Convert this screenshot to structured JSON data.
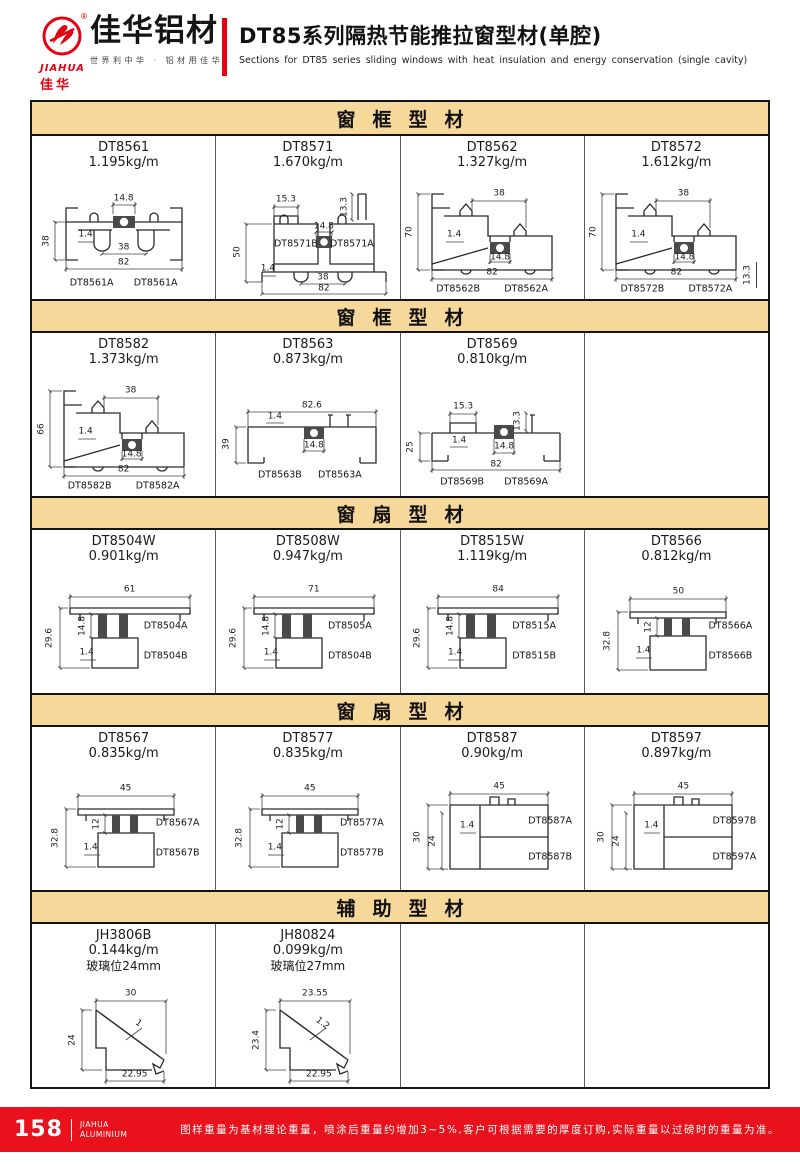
{
  "colors": {
    "accent_red": "#E60012",
    "footer_red": "#E8111C",
    "band_bg": "#F7D89B"
  },
  "header": {
    "logo": {
      "en": "JIAHUA",
      "cn": "佳华",
      "reg": "®"
    },
    "brand": "佳华铝材",
    "slogan": "世界利中华 · 铝材用佳华",
    "title_cn": "DT85系列隔热节能推拉窗型材(单腔)",
    "title_en": "Sections for DT85 series sliding windows with heat insulation and energy conservation (single cavity)"
  },
  "sections": {
    "s1": "窗框型材",
    "s2": "窗框型材",
    "s3": "窗扇型材",
    "s4": "窗扇型材",
    "s5": "辅助型材"
  },
  "cells": {
    "c1": {
      "code": "DT8561",
      "weight": "1.195kg/m",
      "d1": "14.8",
      "d2": "38",
      "d3": "1.4",
      "d4": "38",
      "d5": "82",
      "la": "DT8561A",
      "lb": "DT8561A"
    },
    "c2": {
      "code": "DT8571",
      "weight": "1.670kg/m",
      "d1": "15.3",
      "d2": "13.3",
      "d3": "14.8",
      "d4": "50",
      "d5": "1.4",
      "d6": "38",
      "d7": "82",
      "la": "DT8571B",
      "lb": "DT8571A"
    },
    "c3": {
      "code": "DT8562",
      "weight": "1.327kg/m",
      "d1": "38",
      "d2": "70",
      "d3": "1.4",
      "d4": "14.8",
      "d5": "82",
      "la": "DT8562B",
      "lb": "DT8562A"
    },
    "c4": {
      "code": "DT8572",
      "weight": "1.612kg/m",
      "d1": "38",
      "d2": "70",
      "d3": "14.8",
      "d4": "1.4",
      "d5": "82",
      "d6": "13.3",
      "la": "DT8572B",
      "lb": "DT8572A"
    },
    "c5": {
      "code": "DT8582",
      "weight": "1.373kg/m",
      "d1": "38",
      "d2": "66",
      "d3": "1.4",
      "d4": "14.8",
      "d5": "82",
      "la": "DT8582B",
      "lb": "DT8582A"
    },
    "c6": {
      "code": "DT8563",
      "weight": "0.873kg/m",
      "d1": "82.6",
      "d2": "1.4",
      "d3": "39",
      "d4": "14.8",
      "la": "DT8563B",
      "lb": "DT8563A"
    },
    "c7": {
      "code": "DT8569",
      "weight": "0.810kg/m",
      "d1": "15.3",
      "d2": "13.3",
      "d3": "25",
      "d4": "1.4",
      "d5": "14.8",
      "d6": "82",
      "la": "DT8569B",
      "lb": "DT8569A"
    },
    "c9": {
      "code": "DT8504W",
      "weight": "0.901kg/m",
      "d1": "61",
      "d2": "29.6",
      "d3": "14.8",
      "d4": "1.4",
      "la": "DT8504A",
      "lb": "DT8504B"
    },
    "c10": {
      "code": "DT8508W",
      "weight": "0.947kg/m",
      "d1": "71",
      "d2": "29.6",
      "d3": "14.8",
      "d4": "1.4",
      "la": "DT8505A",
      "lb": "DT8504B"
    },
    "c11": {
      "code": "DT8515W",
      "weight": "1.119kg/m",
      "d1": "84",
      "d2": "29.6",
      "d3": "14.8",
      "d4": "1.4",
      "la": "DT8515A",
      "lb": "DT8515B"
    },
    "c12": {
      "code": "DT8566",
      "weight": "0.812kg/m",
      "d1": "50",
      "d2": "32.8",
      "d3": "12",
      "d4": "1.4",
      "la": "DT8566A",
      "lb": "DT8566B"
    },
    "c13": {
      "code": "DT8567",
      "weight": "0.835kg/m",
      "d1": "45",
      "d2": "32.8",
      "d3": "12",
      "d4": "1.4",
      "la": "DT8567A",
      "lb": "DT8567B"
    },
    "c14": {
      "code": "DT8577",
      "weight": "0.835kg/m",
      "d1": "45",
      "d2": "32.8",
      "d3": "12",
      "d4": "1.4",
      "la": "DT8577A",
      "lb": "DT8577B"
    },
    "c15": {
      "code": "DT8587",
      "weight": "0.90kg/m",
      "d1": "45",
      "d2": "30",
      "d3": "24",
      "d4": "1.4",
      "la": "DT8587A",
      "lb": "DT8587B"
    },
    "c16": {
      "code": "DT8597",
      "weight": "0.897kg/m",
      "d1": "45",
      "d2": "30",
      "d3": "24",
      "d4": "1.4",
      "la": "DT8597B",
      "lb": "DT8597A"
    },
    "c17": {
      "code": "JH3806B",
      "weight": "0.144kg/m",
      "note": "玻璃位24mm",
      "d1": "30",
      "d2": "24",
      "d3": "1",
      "d4": "22.95"
    },
    "c18": {
      "code": "JH80824",
      "weight": "0.099kg/m",
      "note": "玻璃位27mm",
      "d1": "23.55",
      "d2": "23.4",
      "d3": "1.2",
      "d4": "22.95"
    }
  },
  "footer": {
    "page": "158",
    "brand_top": "JIAHUA",
    "brand_bottom": "ALUMINIUM",
    "note": "图样重量为基材理论重量，喷涂后重量约增加3~5%,客户可根据需要的厚度订购,实际重量以过磅时的重量为准。"
  }
}
